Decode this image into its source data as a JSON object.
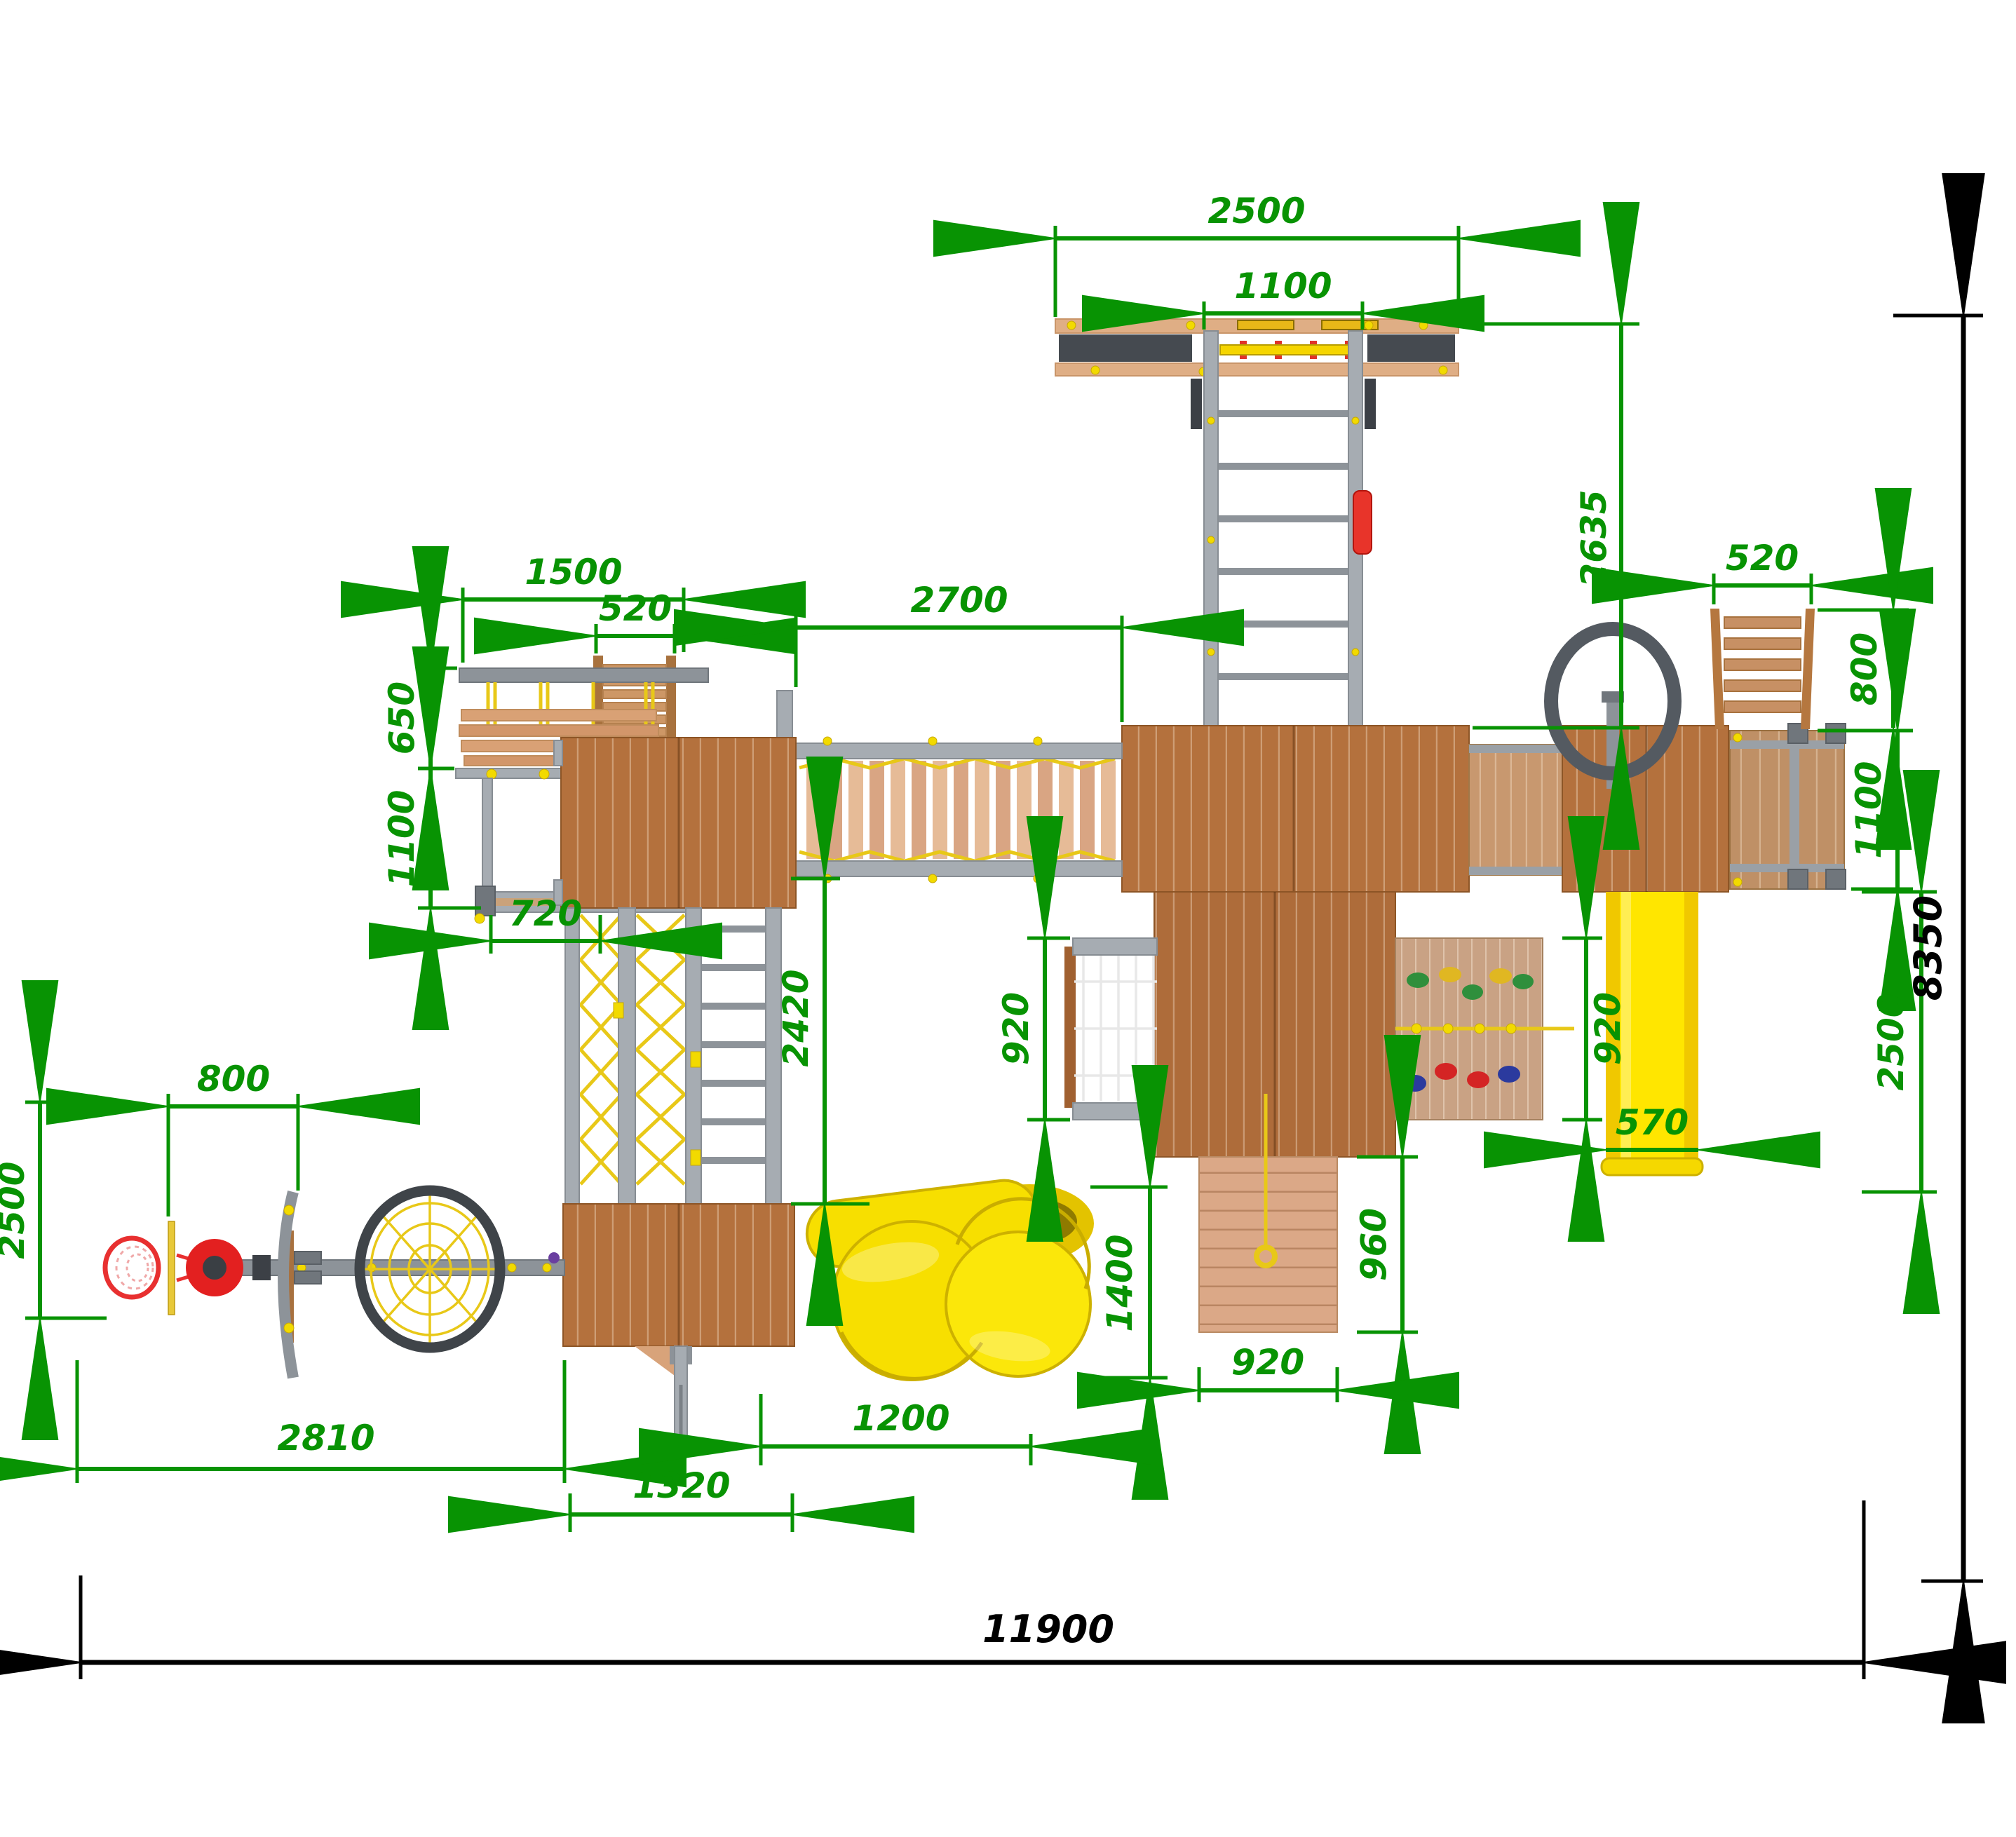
{
  "meta": {
    "drawing_type": "playground equipment plan, top view",
    "units": "mm",
    "dimension_color": "#089303",
    "overall_dimension_color": "#000000"
  },
  "colors": {
    "wood_dark": "#b4713d",
    "wood_light": "#dba887",
    "wood_walkway": "#c8986f",
    "wood_deck": "#bf9066",
    "metal_gray": "#a6acb2",
    "slide_yellow": "#ffe600",
    "spiral_yellow": "#f7df00",
    "rope_yellow": "#e8c818",
    "accent_red": "#e63022",
    "hold_green": "#2f8f3c",
    "hold_blue": "#2b3a9e",
    "hold_red": "#d42424",
    "hold_yellow": "#e0b722"
  },
  "dims": {
    "overall_width": "11900",
    "overall_depth": "8350",
    "beam_width": "2500",
    "beam_inner": "1100",
    "entry_ladder_length": "2635",
    "swing_width": "1500",
    "stairs_width": "520",
    "swing_depth": "650",
    "swing_frame_depth": "1100",
    "frame_width": "720",
    "bridge_length": "2700",
    "tower_drop": "2420",
    "net_height": "920",
    "wall_height": "920",
    "ramp_length": "960",
    "ramp_width": "920",
    "right_ladder_width": "520",
    "right_ladder_length": "800",
    "right_deck_depth": "1100",
    "slide_width": "570",
    "slide_length": "2500",
    "hoop_offset": "800",
    "arm_radius": "2500",
    "arm_length": "2810",
    "spiral_size": "1400",
    "spiral_offset": "1200",
    "lower_platform_width": "1320"
  }
}
